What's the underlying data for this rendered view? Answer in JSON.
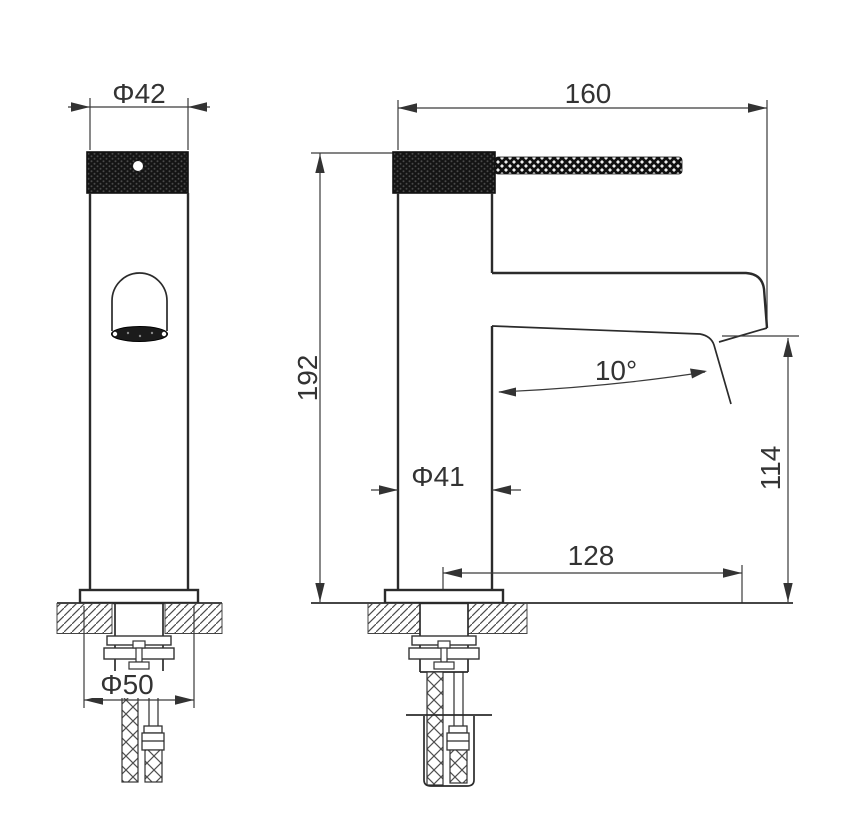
{
  "drawing": {
    "type": "technical-dimension-drawing",
    "views": {
      "front_view": "faucet front elevation",
      "side_view": "faucet side elevation"
    },
    "dimensions": {
      "cap_diameter": "Φ42",
      "overall_depth": "160",
      "total_height": "192",
      "body_diameter": "Φ41",
      "spout_angle": "10°",
      "outlet_height": "114",
      "spout_reach": "128",
      "base_diameter": "Φ50"
    },
    "colors": {
      "line": "#333333",
      "knurl_dark": "#141414",
      "background": "#ffffff"
    }
  }
}
